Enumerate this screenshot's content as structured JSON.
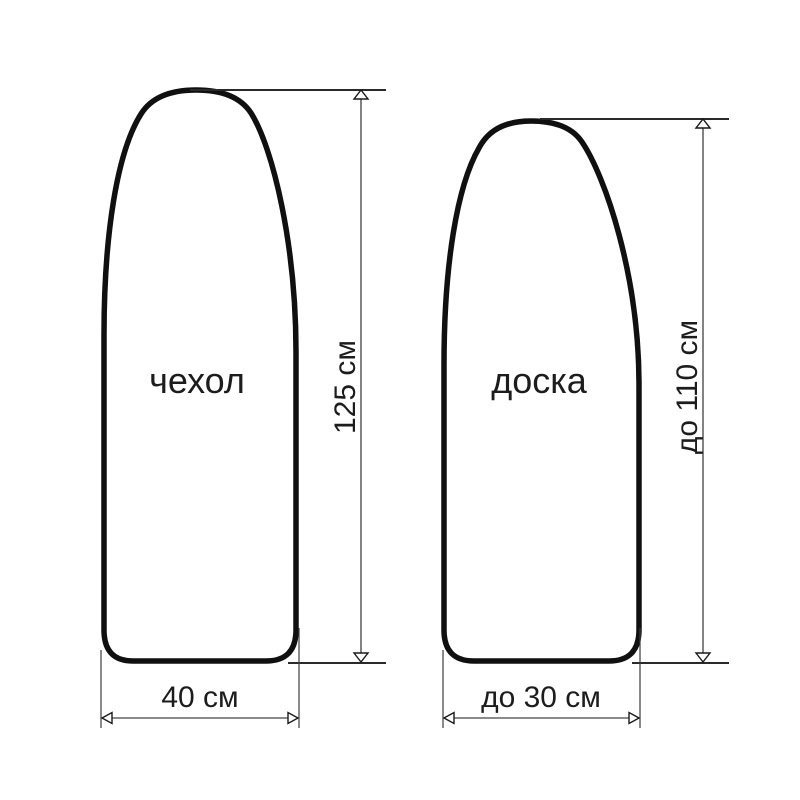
{
  "diagram": {
    "background_color": "#ffffff",
    "outline_color": "#101010",
    "dimension_line_color": "#646464",
    "text_color": "#1c1c1c",
    "cover": {
      "label": "чехол",
      "length_dim": "125 см",
      "width_dim": "40 см"
    },
    "board": {
      "label": "доска",
      "length_dim": "до 110 см",
      "width_dim": "до 30 см"
    }
  }
}
